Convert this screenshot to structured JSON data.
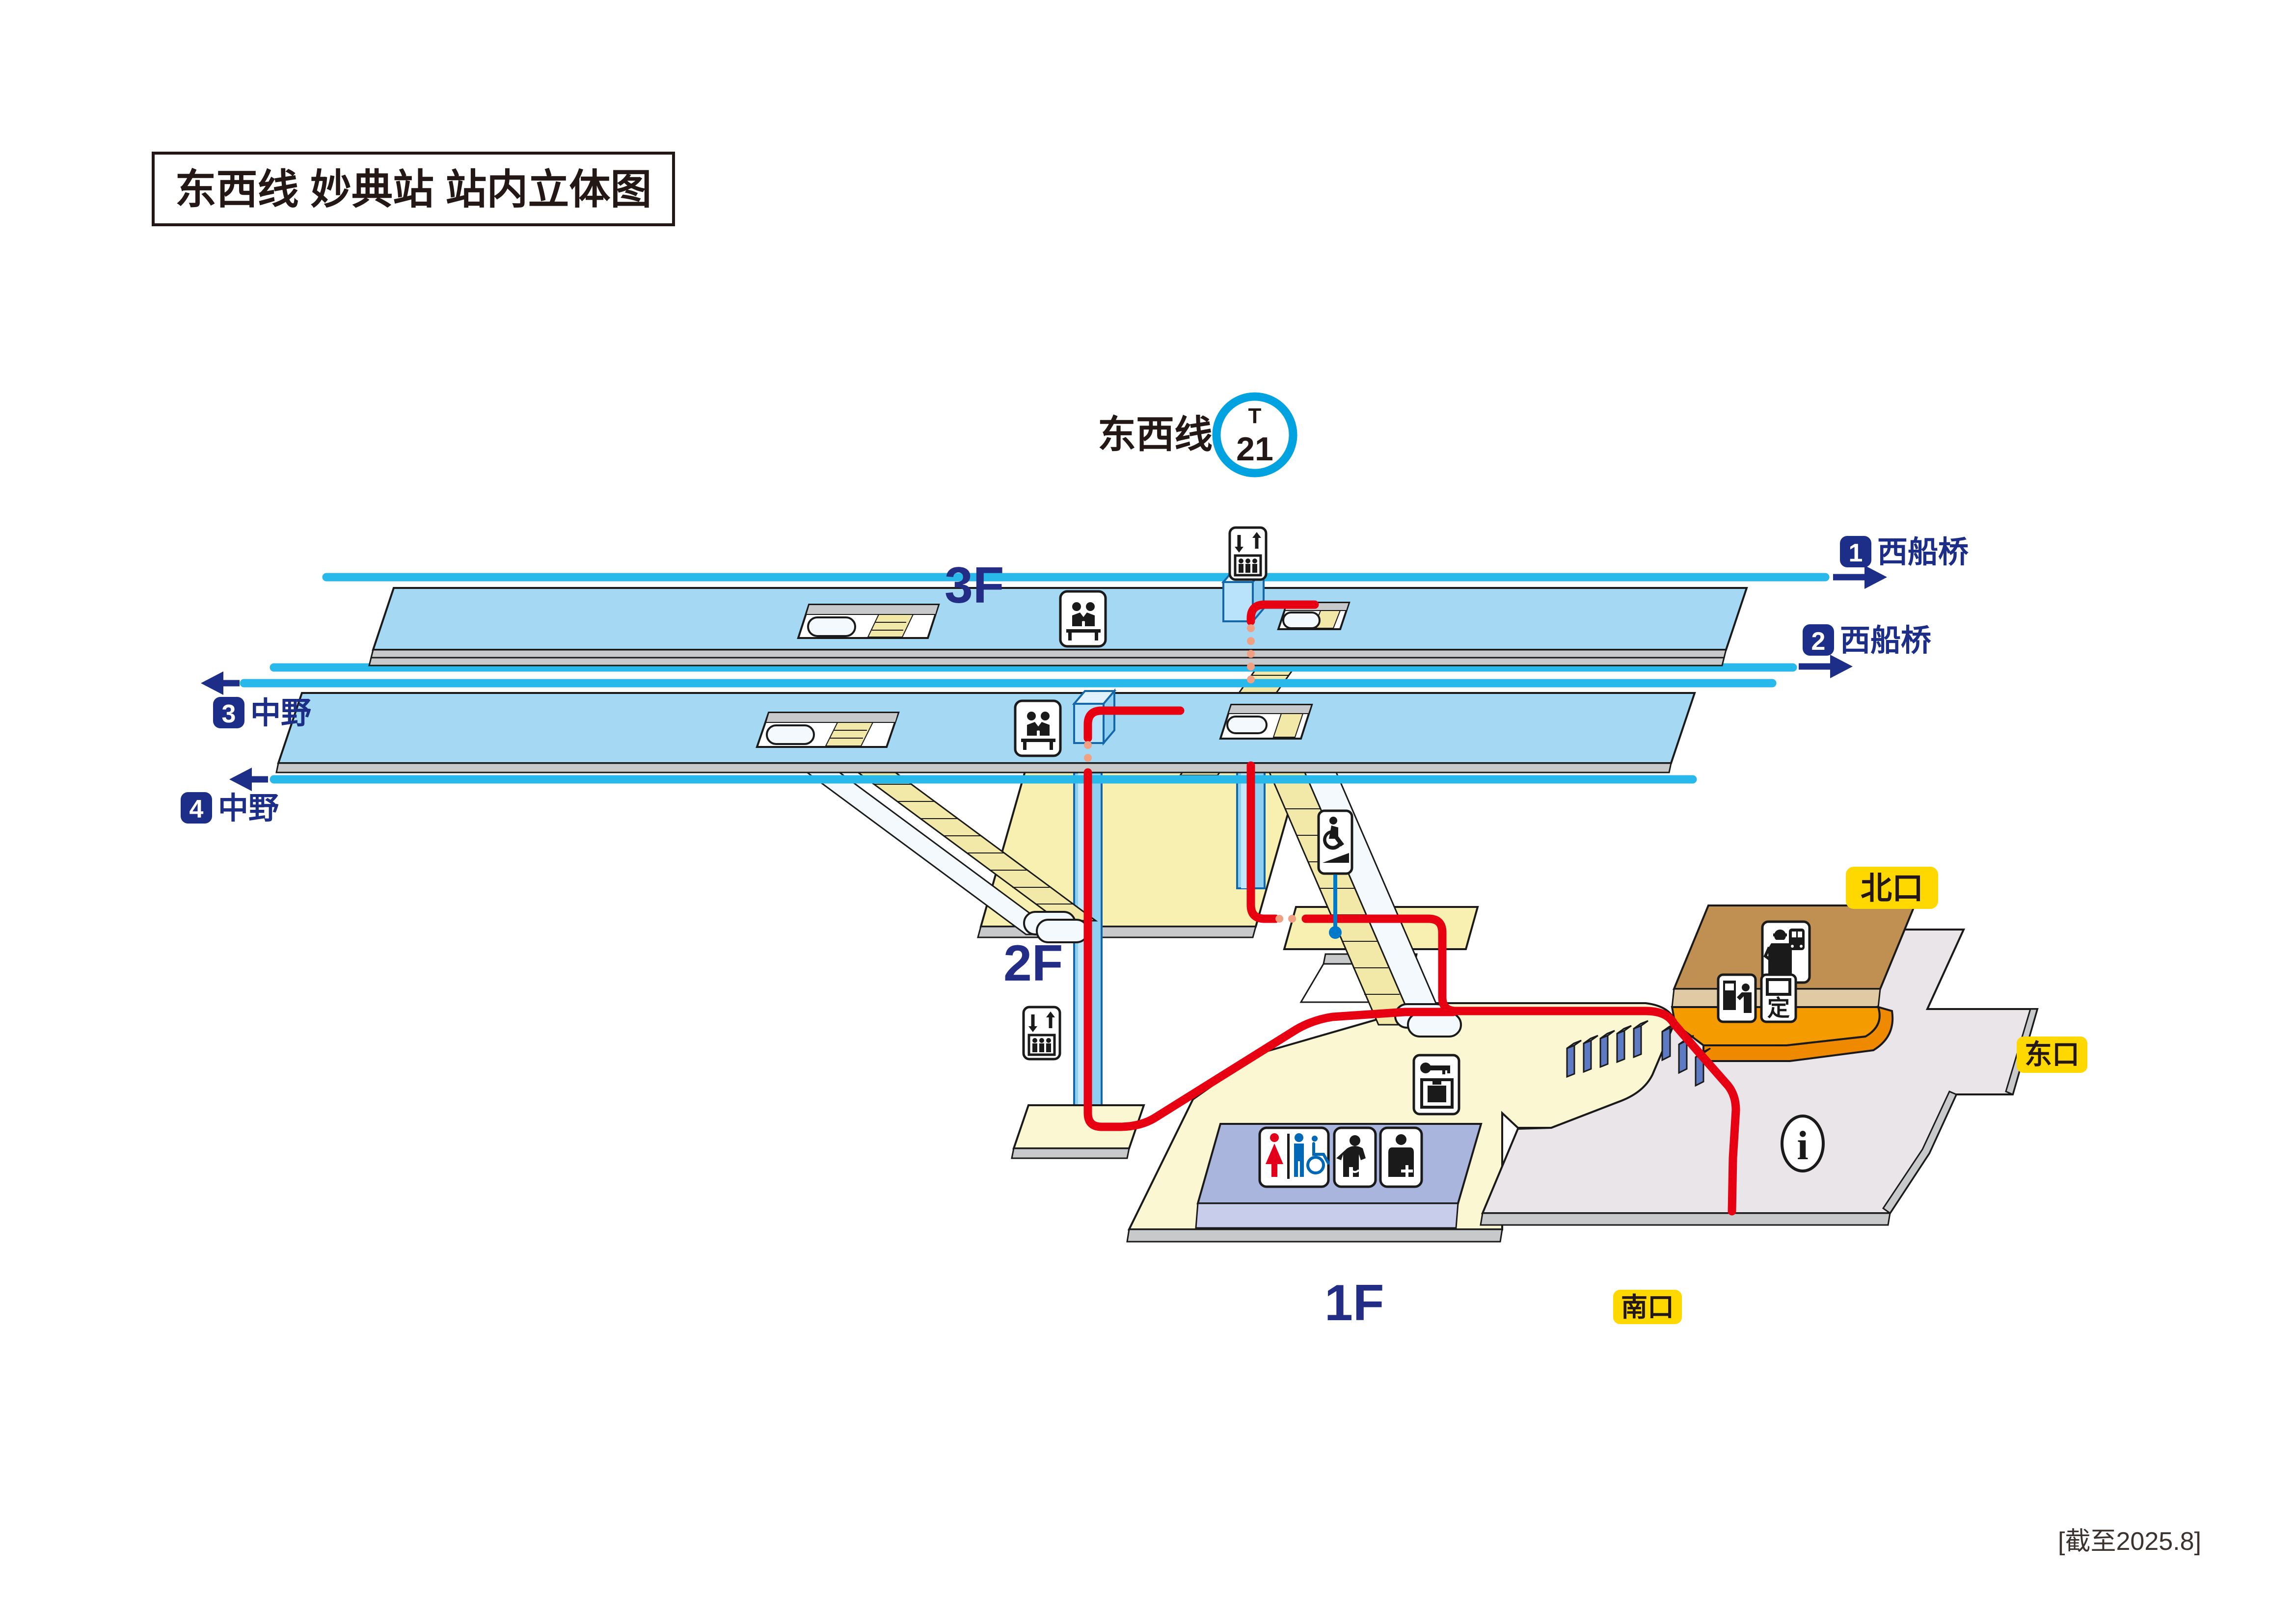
{
  "title": "东西线 妙典站 站内立体图",
  "station_symbol": {
    "line_name": "东西线",
    "code_letter": "T",
    "code_number": "21"
  },
  "floors": [
    {
      "id": "3F",
      "label": "3F"
    },
    {
      "id": "2F",
      "label": "2F"
    },
    {
      "id": "1F",
      "label": "1F"
    }
  ],
  "directions": [
    {
      "track_no": "1",
      "destination": "西船桥",
      "arrow": "right"
    },
    {
      "track_no": "2",
      "destination": "西船桥",
      "arrow": "right"
    },
    {
      "track_no": "3",
      "destination": "中野",
      "arrow": "left"
    },
    {
      "track_no": "4",
      "destination": "中野",
      "arrow": "left"
    }
  ],
  "exits": [
    {
      "id": "north",
      "label": "北口"
    },
    {
      "id": "east",
      "label": "东口"
    },
    {
      "id": "south",
      "label": "南口"
    }
  ],
  "note": "[截至2025.8]",
  "icons": [
    "elevator-icon",
    "bench-icon",
    "escalator-stairs",
    "wheelchair-ramp-icon",
    "coin-locker-icon",
    "toilet-icon",
    "baby-care-icon",
    "nursing-room-icon",
    "station-office-icon",
    "ticket-machine-icon",
    "commuter-pass-machine-icon",
    "information-icon"
  ],
  "icon_text": {
    "commuter_pass_char": "定",
    "information_char": "i"
  },
  "colors": {
    "line_cyan": "#29b8ea",
    "navy": "#1c2e87",
    "route_red": "#e60012",
    "route_dotted_orange": "#f0a083",
    "platform_blue": "#a5d8f2",
    "concourse_yellow": "#f7f0b0",
    "ground_yellow": "#fbf7d2",
    "plaza_gray": "#eae5e8",
    "edge_gray": "#c8c9ca",
    "office_brown": "#c08f52",
    "machine_orange": "#f49b00",
    "toilet_lavender": "#a9b5dd",
    "gate_blue": "#5d7ac2",
    "badge_yellow": "#ffd800",
    "accent_blue": "#0079c8"
  }
}
